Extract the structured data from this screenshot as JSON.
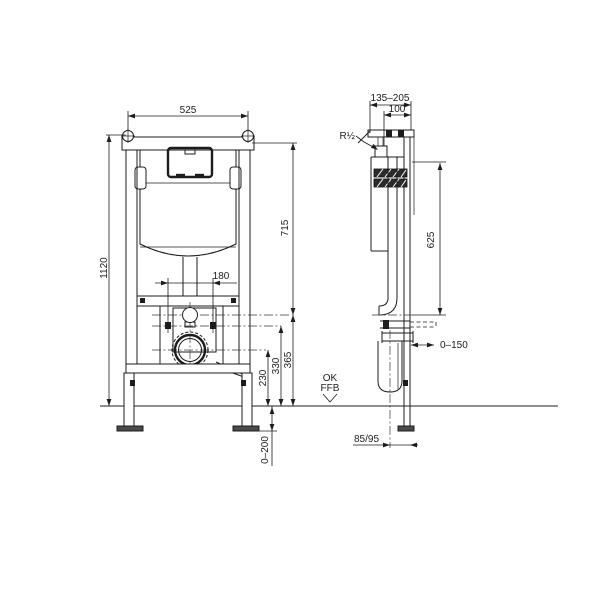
{
  "front_view": {
    "width": "525",
    "height": "1120",
    "upper_height": "715",
    "bolt_spacing": "180",
    "flush_height": "365",
    "bolt_height": "330",
    "outlet_height": "230",
    "foot_adjust": "0–200"
  },
  "side_view": {
    "depth_range": "135–205",
    "depth_min": "100",
    "water_connection": "R½",
    "inlet_height": "625",
    "wall_distance": "0–150",
    "outlet_offset": "85/95",
    "floor_label_1": "OK",
    "floor_label_2": "FFB"
  }
}
